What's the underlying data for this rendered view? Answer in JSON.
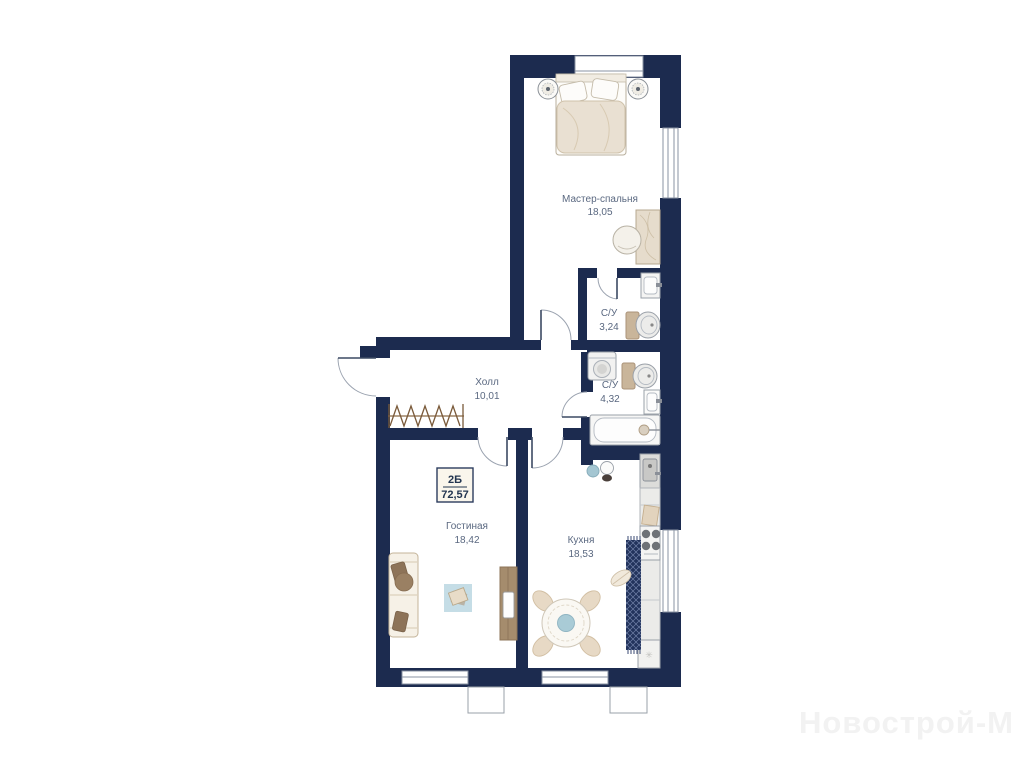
{
  "watermark": "Новострой-М",
  "unit_badge": {
    "type": "2Б",
    "area": "72,57"
  },
  "rooms": [
    {
      "id": "master-bedroom",
      "name": "Мастер-спальня",
      "area": "18,05"
    },
    {
      "id": "bathroom-1",
      "name": "С/У",
      "area": "3,24"
    },
    {
      "id": "bathroom-2",
      "name": "С/У",
      "area": "4,32"
    },
    {
      "id": "hall",
      "name": "Холл",
      "area": "10,01"
    },
    {
      "id": "living-room",
      "name": "Гостиная",
      "area": "18,42"
    },
    {
      "id": "kitchen",
      "name": "Кухня",
      "area": "18,53"
    }
  ],
  "icons": {
    "fridge_snowflake": "✳"
  },
  "colors": {
    "wall": "#1c2b4f",
    "furniture_beige": "#e9e0d2",
    "accent_brown": "#8d7358",
    "rug_blue": "#c5dde6",
    "runner_navy": "#22335c",
    "label_text": "#5a6880"
  }
}
